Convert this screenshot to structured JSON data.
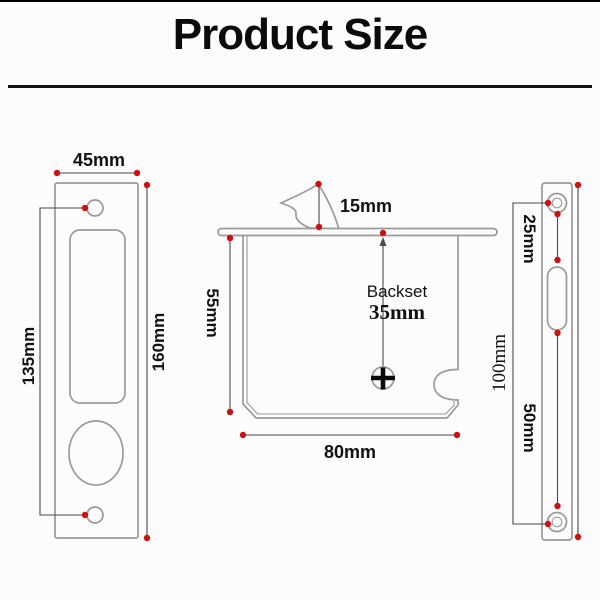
{
  "title": "Product Size",
  "colors": {
    "red": "#cc1111",
    "draw": "#9a9a9a",
    "dim": "#4a4a4a",
    "ink": "#111111"
  },
  "left_plate": {
    "width": "45mm",
    "screws": "135mm",
    "height": "160mm"
  },
  "lock": {
    "hook": "15mm",
    "height": "55mm",
    "backset_caption": "Backset",
    "backset_value": "35mm",
    "width": "80mm"
  },
  "strike": {
    "upper": "25mm",
    "lower": "50mm",
    "screws": "100mm"
  }
}
